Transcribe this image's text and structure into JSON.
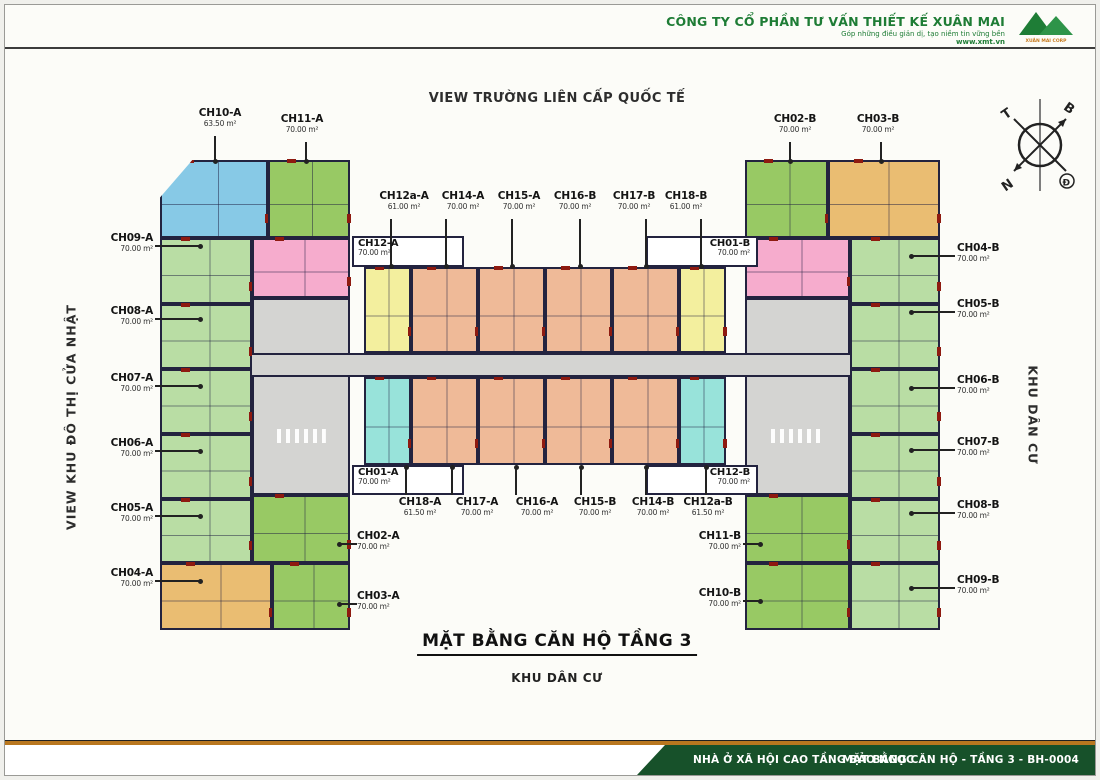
{
  "header": {
    "company": "CÔNG TY CỔ PHẦN TƯ VẤN THIẾT KẾ XUÂN MAI",
    "tagline": "Góp những điều giản dị, tạo niềm tin vững bền",
    "website": "www.xmt.vn",
    "logo_caption": "XUÂN MAI CORP"
  },
  "view_top": "VIEW TRƯỜNG LIÊN CẤP QUỐC TẾ",
  "side_left": "VIEW KHU ĐÔ THỊ CỬA NHẬT",
  "side_right": "KHU DÂN CƯ",
  "title": "MẶT BẰNG CĂN HỘ TẦNG 3",
  "subtitle": "KHU DÂN CƯ",
  "compass": {
    "west": "T",
    "north": "B",
    "south": "N",
    "east": "Đ"
  },
  "footer": {
    "project": "NHÀ Ở XÃ HỘI CAO TẦNG BẢO NGỌC",
    "drawing": "MẶT BẰNG CĂN HỘ - TẦNG 3 - BH-0004"
  },
  "colors": {
    "blue": "#87c9e6",
    "lightgreen": "#b9dda4",
    "medgreen": "#98c964",
    "pink": "#f6accd",
    "orange": "#eabd72",
    "yellow": "#f3ef9e",
    "salmon": "#efba98",
    "cyan": "#98e3da",
    "gray": "#d4d4d2",
    "white": "#ffffff"
  },
  "units": [
    {
      "id": "CH10-A",
      "color": "blue",
      "x": 155,
      "y": 155,
      "w": 108,
      "h": 78,
      "clip": "polygon(30% 0,100% 0,100% 100%,0 100%,0 48%)"
    },
    {
      "id": "CH11-A",
      "color": "medgreen",
      "x": 263,
      "y": 155,
      "w": 82,
      "h": 78
    },
    {
      "id": "CH09-A",
      "color": "lightgreen",
      "x": 155,
      "y": 233,
      "w": 92,
      "h": 66
    },
    {
      "id": "CH08-A",
      "color": "lightgreen",
      "x": 155,
      "y": 299,
      "w": 92,
      "h": 65
    },
    {
      "id": "CH07-A",
      "color": "lightgreen",
      "x": 155,
      "y": 364,
      "w": 92,
      "h": 65
    },
    {
      "id": "CH06-A",
      "color": "lightgreen",
      "x": 155,
      "y": 429,
      "w": 92,
      "h": 65
    },
    {
      "id": "CH05-A",
      "color": "lightgreen",
      "x": 155,
      "y": 494,
      "w": 92,
      "h": 64
    },
    {
      "id": "CH04-A",
      "color": "orange",
      "x": 155,
      "y": 558,
      "w": 112,
      "h": 67
    },
    {
      "id": "CH12-A",
      "color": "pink",
      "x": 247,
      "y": 233,
      "w": 98,
      "h": 60
    },
    {
      "id": "core-A",
      "color": "gray",
      "x": 247,
      "y": 293,
      "w": 98,
      "h": 197,
      "cls": "core"
    },
    {
      "id": "CH02-A",
      "color": "medgreen",
      "x": 247,
      "y": 490,
      "w": 98,
      "h": 68
    },
    {
      "id": "CH03-A",
      "color": "medgreen",
      "x": 267,
      "y": 558,
      "w": 78,
      "h": 67
    },
    {
      "id": "box-CH12-A",
      "color": "white",
      "x": 347,
      "y": 231,
      "w": 112,
      "h": 31,
      "cls": "whitebox"
    },
    {
      "id": "box-CH01-B",
      "color": "white",
      "x": 641,
      "y": 231,
      "w": 112,
      "h": 31,
      "cls": "whitebox"
    },
    {
      "id": "CH12a-A",
      "color": "yellow",
      "x": 359,
      "y": 262,
      "w": 47,
      "h": 86
    },
    {
      "id": "CH14-A",
      "color": "salmon",
      "x": 406,
      "y": 262,
      "w": 67,
      "h": 86
    },
    {
      "id": "CH15-A",
      "color": "salmon",
      "x": 473,
      "y": 262,
      "w": 67,
      "h": 86
    },
    {
      "id": "CH16-B",
      "color": "salmon",
      "x": 540,
      "y": 262,
      "w": 67,
      "h": 86
    },
    {
      "id": "CH17-B",
      "color": "salmon",
      "x": 607,
      "y": 262,
      "w": 67,
      "h": 86
    },
    {
      "id": "CH18-B",
      "color": "yellow",
      "x": 674,
      "y": 262,
      "w": 47,
      "h": 86
    },
    {
      "id": "CH18-A",
      "color": "cyan",
      "x": 359,
      "y": 372,
      "w": 47,
      "h": 88
    },
    {
      "id": "CH17-A",
      "color": "salmon",
      "x": 406,
      "y": 372,
      "w": 67,
      "h": 88
    },
    {
      "id": "CH16-A",
      "color": "salmon",
      "x": 473,
      "y": 372,
      "w": 67,
      "h": 88
    },
    {
      "id": "CH15-B",
      "color": "salmon",
      "x": 540,
      "y": 372,
      "w": 67,
      "h": 88
    },
    {
      "id": "CH14-B",
      "color": "salmon",
      "x": 607,
      "y": 372,
      "w": 67,
      "h": 88
    },
    {
      "id": "CH12a-B",
      "color": "cyan",
      "x": 674,
      "y": 372,
      "w": 47,
      "h": 88
    },
    {
      "id": "box-CH01-A",
      "color": "white",
      "x": 347,
      "y": 460,
      "w": 112,
      "h": 30,
      "cls": "whitebox"
    },
    {
      "id": "box-CH12-B",
      "color": "white",
      "x": 641,
      "y": 460,
      "w": 112,
      "h": 30,
      "cls": "whitebox"
    },
    {
      "id": "CH02-B",
      "color": "medgreen",
      "x": 740,
      "y": 155,
      "w": 83,
      "h": 78
    },
    {
      "id": "CH03-B",
      "color": "orange",
      "x": 823,
      "y": 155,
      "w": 112,
      "h": 78
    },
    {
      "id": "CH01-B",
      "color": "pink",
      "x": 740,
      "y": 233,
      "w": 105,
      "h": 60
    },
    {
      "id": "core-B",
      "color": "gray",
      "x": 740,
      "y": 293,
      "w": 105,
      "h": 197,
      "cls": "core"
    },
    {
      "id": "CH11-B",
      "color": "medgreen",
      "x": 740,
      "y": 490,
      "w": 105,
      "h": 68
    },
    {
      "id": "CH10-B",
      "color": "medgreen",
      "x": 740,
      "y": 558,
      "w": 105,
      "h": 67
    },
    {
      "id": "CH04-B",
      "color": "lightgreen",
      "x": 845,
      "y": 233,
      "w": 90,
      "h": 66
    },
    {
      "id": "CH05-B",
      "color": "lightgreen",
      "x": 845,
      "y": 299,
      "w": 90,
      "h": 65
    },
    {
      "id": "CH06-B",
      "color": "lightgreen",
      "x": 845,
      "y": 364,
      "w": 90,
      "h": 65
    },
    {
      "id": "CH07-B",
      "color": "lightgreen",
      "x": 845,
      "y": 429,
      "w": 90,
      "h": 65
    },
    {
      "id": "CH08-B",
      "color": "lightgreen",
      "x": 845,
      "y": 494,
      "w": 90,
      "h": 64
    },
    {
      "id": "CH09-B",
      "color": "lightgreen",
      "x": 845,
      "y": 558,
      "w": 90,
      "h": 67
    },
    {
      "id": "corridor",
      "color": "gray",
      "x": 247,
      "y": 348,
      "w": 598,
      "h": 24,
      "cls": "corridor"
    }
  ],
  "labels": [
    {
      "name": "CH10-A",
      "area": "63.50 m²",
      "align": "center",
      "x": 175,
      "y": 103,
      "w": 80,
      "leader": [
        209,
        131,
        2,
        26
      ],
      "dot": "s"
    },
    {
      "name": "CH11-A",
      "area": "70.00 m²",
      "align": "center",
      "x": 257,
      "y": 109,
      "w": 80,
      "leader": [
        300,
        137,
        2,
        20
      ],
      "dot": "s"
    },
    {
      "name": "CH02-B",
      "area": "70.00 m²",
      "align": "center",
      "x": 750,
      "y": 109,
      "w": 80,
      "leader": [
        784,
        137,
        2,
        20
      ],
      "dot": "s"
    },
    {
      "name": "CH03-B",
      "area": "70.00 m²",
      "align": "center",
      "x": 833,
      "y": 109,
      "w": 80,
      "leader": [
        875,
        137,
        2,
        20
      ],
      "dot": "s"
    },
    {
      "name": "CH12a-A",
      "area": "61.00 m²",
      "align": "center",
      "x": 370,
      "y": 186,
      "w": 58,
      "leader": [
        385,
        214,
        2,
        48
      ],
      "dot": "s"
    },
    {
      "name": "CH14-A",
      "area": "70.00 m²",
      "align": "center",
      "x": 429,
      "y": 186,
      "w": 58,
      "leader": [
        440,
        214,
        2,
        48
      ],
      "dot": "s"
    },
    {
      "name": "CH15-A",
      "area": "70.00 m²",
      "align": "center",
      "x": 485,
      "y": 186,
      "w": 58,
      "leader": [
        506,
        214,
        2,
        48
      ],
      "dot": "s"
    },
    {
      "name": "CH16-B",
      "area": "70.00 m²",
      "align": "center",
      "x": 541,
      "y": 186,
      "w": 58,
      "leader": [
        574,
        214,
        2,
        48
      ],
      "dot": "s"
    },
    {
      "name": "CH17-B",
      "area": "70.00 m²",
      "align": "center",
      "x": 600,
      "y": 186,
      "w": 58,
      "leader": [
        640,
        214,
        2,
        48
      ],
      "dot": "s"
    },
    {
      "name": "CH18-B",
      "area": "61.00 m²",
      "align": "center",
      "x": 652,
      "y": 186,
      "w": 58,
      "leader": [
        695,
        214,
        2,
        48
      ],
      "dot": "s"
    },
    {
      "name": "CH09-A",
      "area": "70.00 m²",
      "align": "right",
      "x": 62,
      "y": 228,
      "w": 86,
      "leader": [
        150,
        240,
        46,
        2
      ],
      "dot": "e"
    },
    {
      "name": "CH08-A",
      "area": "70.00 m²",
      "align": "right",
      "x": 62,
      "y": 301,
      "w": 86,
      "leader": [
        150,
        313,
        46,
        2
      ],
      "dot": "e"
    },
    {
      "name": "CH07-A",
      "area": "70.00 m²",
      "align": "right",
      "x": 62,
      "y": 368,
      "w": 86,
      "leader": [
        150,
        380,
        46,
        2
      ],
      "dot": "e"
    },
    {
      "name": "CH06-A",
      "area": "70.00 m²",
      "align": "right",
      "x": 62,
      "y": 433,
      "w": 86,
      "leader": [
        150,
        445,
        46,
        2
      ],
      "dot": "e"
    },
    {
      "name": "CH05-A",
      "area": "70.00 m²",
      "align": "right",
      "x": 62,
      "y": 498,
      "w": 86,
      "leader": [
        150,
        510,
        46,
        2
      ],
      "dot": "e"
    },
    {
      "name": "CH04-A",
      "area": "70.00 m²",
      "align": "right",
      "x": 62,
      "y": 563,
      "w": 86,
      "leader": [
        150,
        575,
        46,
        2
      ],
      "dot": "e"
    },
    {
      "name": "CH04-B",
      "area": "70.00 m²",
      "align": "left",
      "x": 952,
      "y": 238,
      "w": 86,
      "leader": [
        906,
        250,
        44,
        2
      ],
      "dot": "w"
    },
    {
      "name": "CH05-B",
      "area": "70.00 m²",
      "align": "left",
      "x": 952,
      "y": 294,
      "w": 86,
      "leader": [
        906,
        306,
        44,
        2
      ],
      "dot": "w"
    },
    {
      "name": "CH06-B",
      "area": "70.00 m²",
      "align": "left",
      "x": 952,
      "y": 370,
      "w": 86,
      "leader": [
        906,
        382,
        44,
        2
      ],
      "dot": "w"
    },
    {
      "name": "CH07-B",
      "area": "70.00 m²",
      "align": "left",
      "x": 952,
      "y": 432,
      "w": 86,
      "leader": [
        906,
        444,
        44,
        2
      ],
      "dot": "w"
    },
    {
      "name": "CH08-B",
      "area": "70.00 m²",
      "align": "left",
      "x": 952,
      "y": 495,
      "w": 86,
      "leader": [
        906,
        507,
        44,
        2
      ],
      "dot": "w"
    },
    {
      "name": "CH09-B",
      "area": "70.00 m²",
      "align": "left",
      "x": 952,
      "y": 570,
      "w": 86,
      "leader": [
        906,
        582,
        44,
        2
      ],
      "dot": "w"
    },
    {
      "name": "CH12-A",
      "area": "70.00 m²",
      "align": "left",
      "x": 353,
      "y": 233,
      "w": 100,
      "boxed": true
    },
    {
      "name": "CH01-B",
      "area": "70.00 m²",
      "align": "right",
      "x": 645,
      "y": 233,
      "w": 100,
      "boxed": true
    },
    {
      "name": "CH01-A",
      "area": "70.00 m²",
      "align": "left",
      "x": 353,
      "y": 462,
      "w": 100,
      "boxed": true
    },
    {
      "name": "CH12-B",
      "area": "70.00 m²",
      "align": "right",
      "x": 645,
      "y": 462,
      "w": 100,
      "boxed": true
    },
    {
      "name": "CH18-A",
      "area": "61.50 m²",
      "align": "center",
      "x": 387,
      "y": 492,
      "w": 56,
      "leader": [
        400,
        462,
        2,
        28
      ],
      "dot": "n"
    },
    {
      "name": "CH17-A",
      "area": "70.00 m²",
      "align": "center",
      "x": 444,
      "y": 492,
      "w": 56,
      "leader": [
        446,
        462,
        2,
        28
      ],
      "dot": "n"
    },
    {
      "name": "CH16-A",
      "area": "70.00 m²",
      "align": "center",
      "x": 504,
      "y": 492,
      "w": 56,
      "leader": [
        510,
        462,
        2,
        28
      ],
      "dot": "n"
    },
    {
      "name": "CH15-B",
      "area": "70.00 m²",
      "align": "center",
      "x": 562,
      "y": 492,
      "w": 56,
      "leader": [
        575,
        462,
        2,
        28
      ],
      "dot": "n"
    },
    {
      "name": "CH14-B",
      "area": "70.00 m²",
      "align": "center",
      "x": 620,
      "y": 492,
      "w": 56,
      "leader": [
        640,
        462,
        2,
        28
      ],
      "dot": "n"
    },
    {
      "name": "CH12a-B",
      "area": "61.50 m²",
      "align": "center",
      "x": 675,
      "y": 492,
      "w": 56,
      "leader": [
        700,
        462,
        2,
        28
      ],
      "dot": "n"
    },
    {
      "name": "CH02-A",
      "area": "70.00 m²",
      "align": "left",
      "x": 352,
      "y": 526,
      "w": 70,
      "leader": [
        334,
        538,
        18,
        2
      ],
      "dot": "w"
    },
    {
      "name": "CH03-A",
      "area": "70.00 m²",
      "align": "left",
      "x": 352,
      "y": 586,
      "w": 70,
      "leader": [
        334,
        598,
        18,
        2
      ],
      "dot": "w"
    },
    {
      "name": "CH11-B",
      "area": "70.00 m²",
      "align": "right",
      "x": 666,
      "y": 526,
      "w": 70,
      "leader": [
        738,
        538,
        18,
        2
      ],
      "dot": "e"
    },
    {
      "name": "CH10-B",
      "area": "70.00 m²",
      "align": "right",
      "x": 666,
      "y": 583,
      "w": 70,
      "leader": [
        738,
        595,
        18,
        2
      ],
      "dot": "e"
    }
  ]
}
